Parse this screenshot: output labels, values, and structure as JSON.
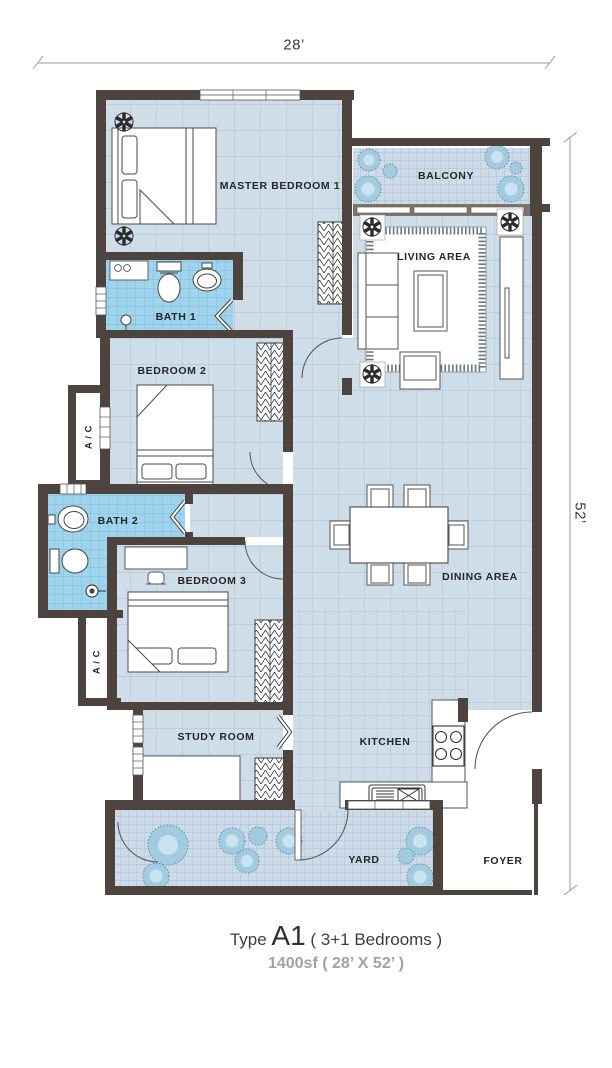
{
  "title": "Floor plan Type A1",
  "dimensions": {
    "width_label": "28’",
    "height_label": "52’"
  },
  "rooms": [
    {
      "id": "master-bedroom-1",
      "label": "MASTER BEDROOM 1"
    },
    {
      "id": "balcony",
      "label": "BALCONY"
    },
    {
      "id": "living-area",
      "label": "LIVING AREA"
    },
    {
      "id": "bath-1",
      "label": "BATH 1"
    },
    {
      "id": "bedroom-2",
      "label": "BEDROOM 2"
    },
    {
      "id": "ac-upper",
      "label": "A / C"
    },
    {
      "id": "bath-2",
      "label": "BATH 2"
    },
    {
      "id": "bedroom-3",
      "label": "BEDROOM 3"
    },
    {
      "id": "ac-lower",
      "label": "A / C"
    },
    {
      "id": "study-room",
      "label": "STUDY ROOM"
    },
    {
      "id": "dining-area",
      "label": "DINING AREA"
    },
    {
      "id": "kitchen",
      "label": "KITCHEN"
    },
    {
      "id": "yard",
      "label": "YARD"
    },
    {
      "id": "foyer",
      "label": "FOYER"
    }
  ],
  "caption": {
    "type_prefix": "Type ",
    "type_code": "A1",
    "type_suffix": " ( 3+1 Bedrooms )",
    "size_line": "1400sf ( 28’ X 52’ )"
  },
  "icons": [
    "ceiling-fan-icon",
    "plant-icon",
    "bed-icon",
    "sofa-icon",
    "toilet-icon",
    "sink-icon",
    "shower-icon",
    "stove-icon",
    "kitchen-sink-icon",
    "wardrobe-icon",
    "dining-table-icon",
    "door-swing-icon",
    "window-icon"
  ],
  "colors": {
    "wall": "#4d443f",
    "floor_tile": "#cfdde9",
    "floor_grid": "#a9bed2",
    "bath_tile": "#9fd4ec",
    "bath_grid": "#6cb6d6",
    "plant_fill": "#a3cbdf",
    "plant_inner": "#c9e4f0",
    "dimension_line": "#9a9a9a",
    "caption_gray": "#a2a2a2"
  }
}
